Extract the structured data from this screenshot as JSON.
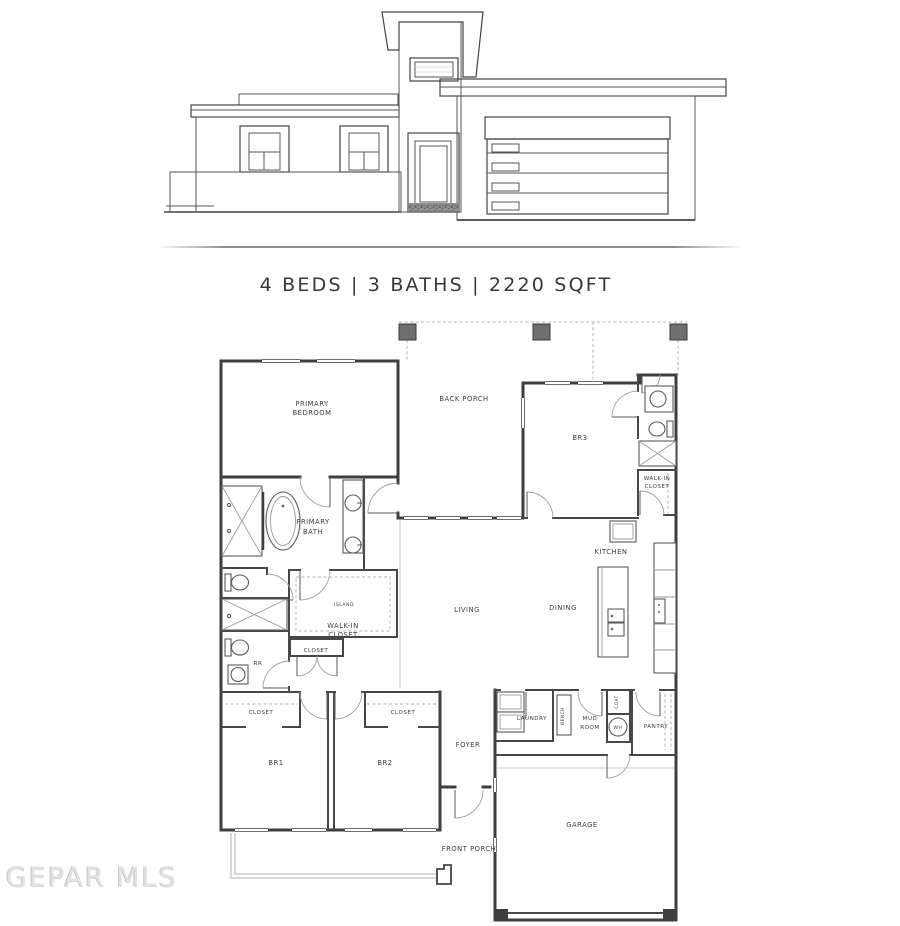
{
  "header": {
    "summary": "4 BEDS | 3 BATHS | 2220 SQFT"
  },
  "watermark": {
    "text": "GEPAR MLS"
  },
  "colors": {
    "wall": "#3e3e3e",
    "label_text": "#3c3c3c",
    "door_arc": "#9f9f9f",
    "porch_column_fill": "#6f6f6f",
    "watermark_text": "#e2e2e2",
    "divider_line": "#8f8f8f",
    "dark_masonry": "#8f8f8f",
    "stucco_base": "#fdfdfd"
  },
  "icons": {
    "fixtures": [
      "tub-icon",
      "toilet-icon",
      "sink-icon",
      "shower-icon",
      "washer-icon",
      "dryer-icon",
      "water-heater-icon",
      "kitchen-island-icon",
      "kitchen-counter-icon",
      "refrigerator-icon",
      "bench-icon",
      "porch-column-icon"
    ]
  },
  "floorplan": {
    "rooms": {
      "primary_bedroom": {
        "line1": "PRIMARY",
        "line2": "BEDROOM"
      },
      "back_porch": "BACK PORCH",
      "br3": "BR3",
      "walk_in_closet_right": {
        "line1": "WALK-IN",
        "line2": "CLOSET"
      },
      "kitchen": "KITCHEN",
      "primary_bath": {
        "line1": "PRIMARY",
        "line2": "BATH"
      },
      "living": "LIVING",
      "dining": "DINING",
      "island": "ISLAND",
      "walk_in_closet_left": {
        "line1": "WALK-IN",
        "line2": "CLOSET"
      },
      "closet_linen": "CLOSET",
      "rr": "RR",
      "closet_br1": "CLOSET",
      "closet_br2": "CLOSET",
      "br1": "BR1",
      "br2": "BR2",
      "laundry": "LAUNDRY",
      "bench": "BENCH",
      "mud_room": {
        "line1": "MUD",
        "line2": "ROOM"
      },
      "coat": "COAT",
      "wh": "WH",
      "pantry": "PANTRY",
      "foyer": "FOYER",
      "front_porch": "FRONT PORCH",
      "garage": "GARAGE"
    }
  }
}
